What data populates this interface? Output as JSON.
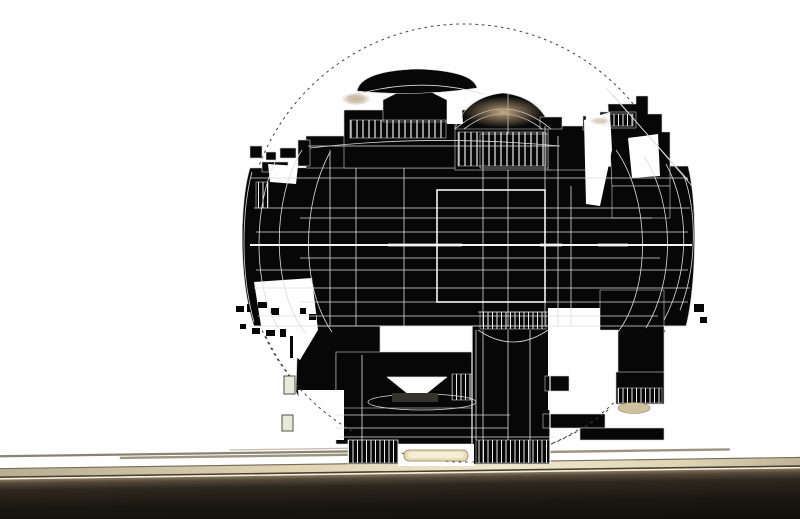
{
  "meta": {
    "type": "3d-wireframe-render",
    "description": "Monochrome 3D wireframe render of a spherical mechanical structure (black silhouette with white construction lines) enclosed in a dashed construction circle, hovering above a lit tan ground strip with a dark foreground band. No text is visible in the image."
  },
  "colors": {
    "background": "#fefefe",
    "silhouette": "#070707",
    "edge_stroke": "#cfcfcf",
    "wireframe": "#dcdcdc",
    "wireframe_bright": "#f6f6f6",
    "dashed_circle": "#3f3f3f",
    "tick_lines": "#ececec",
    "slab_grey": "#34332e",
    "ground_strip_a": "#8b8371",
    "ground_strip_b": "#9d947f",
    "ground_strip_c": "#c4bcab",
    "band_left": "#b7ab90",
    "band_mid": "#ded2b3",
    "band_bright": "#f1e8cd",
    "band_right": "#b9ad92",
    "band_top_edge": "#776c57",
    "band_bottom_edge": "#4a4134",
    "band_highlight": "#f4edd8",
    "dark_1": "#85775f",
    "dark_2": "#55483a",
    "dark_3": "#2e271e",
    "dark_4": "#1a1611",
    "dark_5": "#100d09",
    "brass_core": "#cdb690",
    "brass_mid": "#a89070",
    "pill_fill": "#e8ddbb",
    "pill_edge": "#a2966f",
    "pill_bright": "#f6efd6",
    "tan_ellipse": "#cfc09e",
    "tan_ellipse_edge": "#8d7f60",
    "green_box_fill": "#e7ead9",
    "green_box_edge": "#50504a"
  },
  "scene": {
    "parts": [
      "dashed-construction-circle",
      "spherical-machine-silhouette",
      "pagoda-roof-structure",
      "colonnade-dome",
      "stepped-right-tower",
      "central-barrel-with-grid",
      "central-support-column",
      "pedestal-feet",
      "funnel-dish-detail",
      "debris-fragments",
      "ground-strips",
      "lit-ground-band",
      "dark-foreground-band"
    ]
  }
}
